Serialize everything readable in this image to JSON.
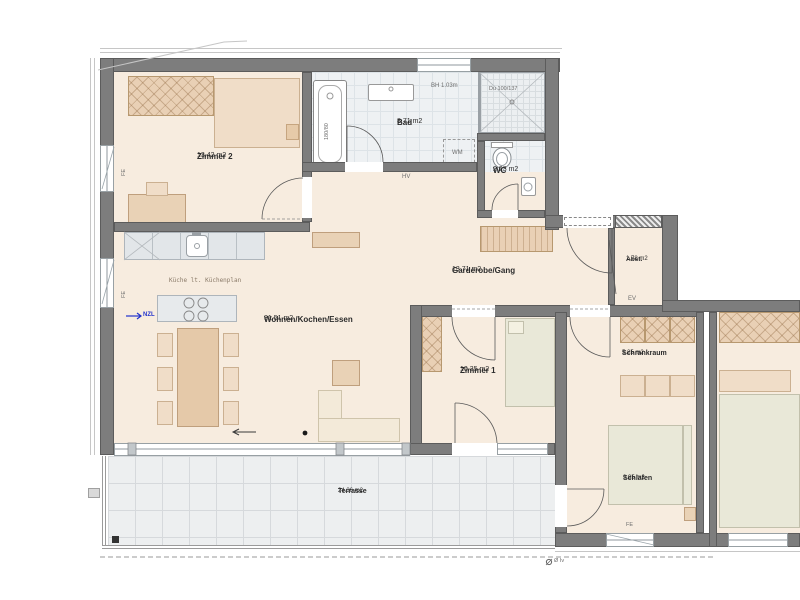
{
  "rooms": {
    "zimmer2": {
      "name": "Zimmer 2",
      "area": "13.42 m2"
    },
    "bad": {
      "name": "Bad",
      "area": "8.71 m2"
    },
    "wc": {
      "name": "WC",
      "area": "2.23 m2"
    },
    "garderobe": {
      "name": "Garderobe/Gang",
      "area": "13.71 m2"
    },
    "abst": {
      "name": "Abst.",
      "area": "1.78 m2"
    },
    "wohnen": {
      "name": "Wohnen/Kochen/Essen",
      "area": "31.51 m2"
    },
    "zimmer1": {
      "name": "Zimmer 1",
      "area": "10.35 m2"
    },
    "schrankraum": {
      "name": "Schrankraum",
      "area": "5.25 m2"
    },
    "schlafen": {
      "name": "Schlafen",
      "area": "9.95 m2"
    },
    "terrasse": {
      "name": "Terrasse",
      "area": "24.36 m2"
    }
  },
  "annotations": {
    "kitchen_note": "Küche lt. Küchenplan",
    "tub_size": "180/80",
    "shower": "Du 100/137",
    "window_height": "BH 1.03m",
    "washing_machine": "WM",
    "hv": "HV",
    "ev": "EV",
    "fe": "FE",
    "supply_air": "NZL",
    "drain": "Ø Iv"
  },
  "colors": {
    "wall": "#7d7d7d",
    "floor": "#f7ecdf",
    "accent_blue": "#2233cc"
  }
}
